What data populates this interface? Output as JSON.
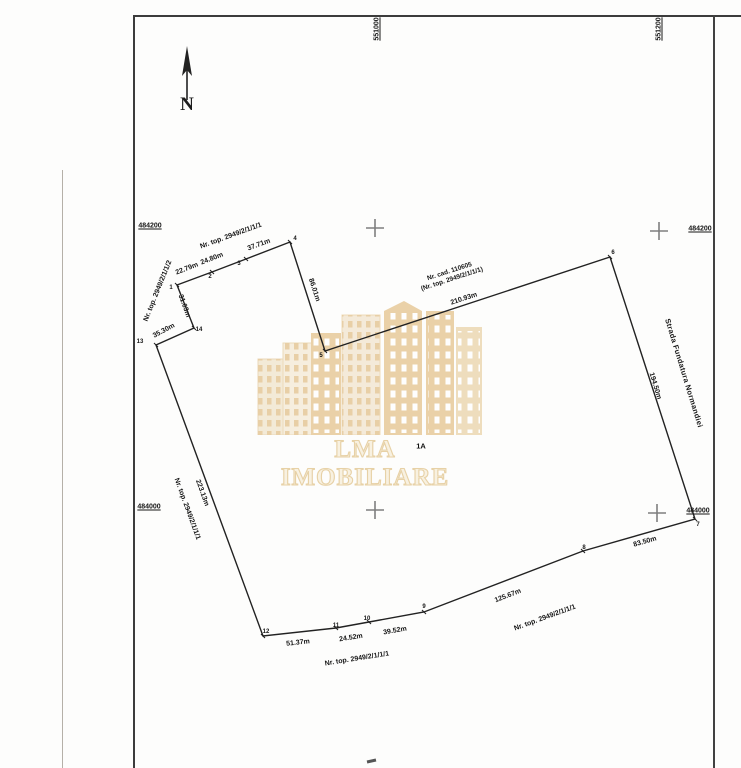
{
  "north": {
    "label": "N"
  },
  "watermark": {
    "text": "LMA IMOBILIARE",
    "tan_color": "#e9cfa6",
    "light_color": "#f4ead8"
  },
  "grid": {
    "cross_color": "#7e7e7e",
    "crosses": [
      {
        "x": 375,
        "y": 228
      },
      {
        "x": 659,
        "y": 231
      },
      {
        "x": 375,
        "y": 510
      },
      {
        "x": 657,
        "y": 513
      }
    ],
    "coord_labels": [
      {
        "t": "551000",
        "x": 377,
        "y": 29,
        "vertical": true
      },
      {
        "t": "551200",
        "x": 659,
        "y": 29,
        "vertical": true
      },
      {
        "t": "484200",
        "x": 150,
        "y": 226,
        "vertical": false
      },
      {
        "t": "484200",
        "x": 700,
        "y": 229,
        "vertical": false
      },
      {
        "t": "484000",
        "x": 149,
        "y": 507,
        "vertical": false
      },
      {
        "t": "484000",
        "x": 698,
        "y": 511,
        "vertical": false
      }
    ]
  },
  "parcel": {
    "cadastral_number_line1": "Nr. cad. 110605",
    "cadastral_number_line2": "(Nr. top. 2949/2/1/1/1)",
    "lot_label": "1A",
    "line_color": "#222222",
    "polygon_px": [
      [
        177,
        285
      ],
      [
        212,
        272
      ],
      [
        246,
        259
      ],
      [
        290,
        242
      ],
      [
        325,
        351
      ],
      [
        610,
        257
      ],
      [
        695,
        519
      ],
      [
        583,
        551
      ],
      [
        424,
        612
      ],
      [
        369,
        622
      ],
      [
        336,
        628
      ],
      [
        263,
        636
      ],
      [
        156,
        345
      ],
      [
        194,
        328
      ]
    ],
    "vertex_labels": [
      {
        "t": "1",
        "x": 171,
        "y": 288
      },
      {
        "t": "2",
        "x": 210,
        "y": 277
      },
      {
        "t": "3",
        "x": 239,
        "y": 264
      },
      {
        "t": "4",
        "x": 295,
        "y": 239
      },
      {
        "t": "5",
        "x": 321,
        "y": 356
      },
      {
        "t": "6",
        "x": 613,
        "y": 253
      },
      {
        "t": "7",
        "x": 698,
        "y": 525
      },
      {
        "t": "8",
        "x": 584,
        "y": 548
      },
      {
        "t": "9",
        "x": 424,
        "y": 607
      },
      {
        "t": "10",
        "x": 367,
        "y": 619
      },
      {
        "t": "11",
        "x": 336,
        "y": 626
      },
      {
        "t": "12",
        "x": 266,
        "y": 632
      },
      {
        "t": "13",
        "x": 140,
        "y": 342
      },
      {
        "t": "14",
        "x": 199,
        "y": 330
      }
    ],
    "edge_length_labels": [
      {
        "t": "22.79m",
        "x": 187,
        "y": 269,
        "r": -21
      },
      {
        "t": "24.80m",
        "x": 212,
        "y": 259,
        "r": -21
      },
      {
        "t": "37.71m",
        "x": 259,
        "y": 245,
        "r": -20
      },
      {
        "t": "86.01m",
        "x": 314,
        "y": 290,
        "r": 72
      },
      {
        "t": "210.93m",
        "x": 464,
        "y": 299,
        "r": -18
      },
      {
        "t": "194.50m",
        "x": 655,
        "y": 386,
        "r": 73
      },
      {
        "t": "83.50m",
        "x": 645,
        "y": 542,
        "r": -16
      },
      {
        "t": "125.67m",
        "x": 508,
        "y": 596,
        "r": -21
      },
      {
        "t": "39.52m",
        "x": 395,
        "y": 631,
        "r": -10
      },
      {
        "t": "24.52m",
        "x": 351,
        "y": 638,
        "r": -9
      },
      {
        "t": "51.37m",
        "x": 298,
        "y": 643,
        "r": -6
      },
      {
        "t": "223.13m",
        "x": 202,
        "y": 493,
        "r": 70
      },
      {
        "t": "35.30m",
        "x": 164,
        "y": 331,
        "r": -28
      },
      {
        "t": "31.03m",
        "x": 184,
        "y": 306,
        "r": 70
      }
    ],
    "neighbor_labels": [
      {
        "t": "Nr. top. 2949/2/1/1/1",
        "x": 231,
        "y": 236,
        "r": -20
      },
      {
        "t": "Nr. top. 2949/2/1/1/2",
        "x": 158,
        "y": 291,
        "r": -68
      },
      {
        "t": "Nr. top. 2949/2/1/1/1",
        "x": 187,
        "y": 509,
        "r": 70
      },
      {
        "t": "Nr. top. 2949/2/1/1/1",
        "x": 357,
        "y": 659,
        "r": -9
      },
      {
        "t": "Nr. top. 2949/2/1/1/1",
        "x": 545,
        "y": 618,
        "r": -20
      }
    ],
    "street_label": {
      "t": "Strada Fundatura Normandiei",
      "x": 684,
      "y": 373,
      "r": 73
    }
  }
}
